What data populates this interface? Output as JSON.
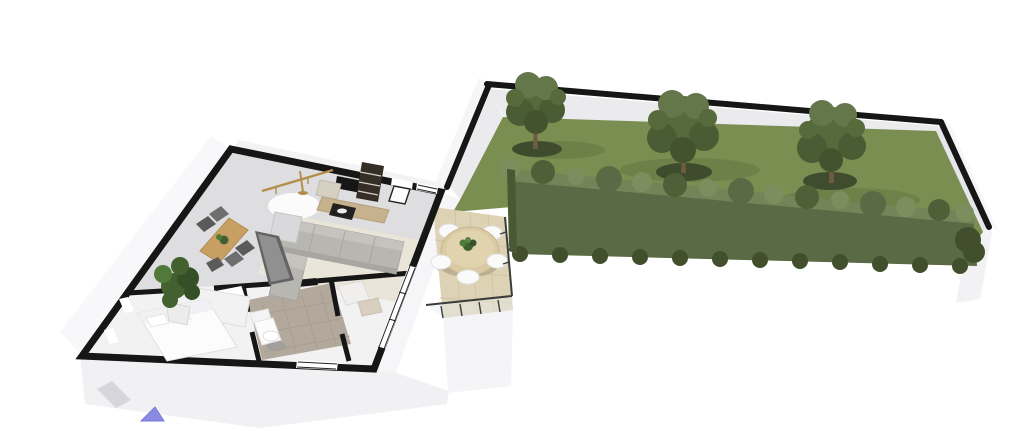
{
  "scene": {
    "type": "floorplanner-3d-view",
    "background": "#ffffff",
    "colors": {
      "wall": "#161616",
      "wall_face": "#ebebee",
      "exterior_face": "#f4f4f6",
      "floor_living": "#dedee0",
      "floor_white": "#f2f2f3",
      "rug": "#e9e5d9",
      "round_rug": "#fcfcfc",
      "sofa": "#b8b6b1",
      "sofa_light": "#c5c3be",
      "coffee_table": "#23211f",
      "tv": "#161616",
      "sideboard": "#c6b28d",
      "shelf": "#352e26",
      "brass": "#b28f49",
      "armchair": "#d6d0c2",
      "wood": "#c79f62",
      "chair_dark": "#5a5a5a",
      "kitchen_dark": "#646464",
      "kitchen_top": "#909090",
      "cabinet": "#d9d9db",
      "bathroom_tile": "#b2a89b",
      "fixture": "#fcfcfd",
      "plant": "#42612f",
      "pot": "#ececea",
      "terrace_floor": "#ddd2b4",
      "terrace_table": "#d9caa3",
      "railing": "#3c3c3c",
      "glass": "#e9eef1",
      "grass": "#7a8e52",
      "grass_dark": "#55682f",
      "hedge": "#5a6a44",
      "hedge_light": "#7c8e5e",
      "hedge_dark": "#414f2c",
      "tree": "#566a3c",
      "tree_light": "#63774a",
      "tree_dark": "#42532e",
      "tree_shadow": "#39462a",
      "trunk": "#6f5b40",
      "camera_marker": "#8a8ae4"
    },
    "garden": {
      "tree_count": 3,
      "has_hedge": true,
      "has_lawn": true,
      "enclosed_by_walls": true
    },
    "terrace": {
      "chair_count": 5,
      "has_round_table": true,
      "has_railing": true,
      "has_centerpiece_plant": true
    },
    "apartment": {
      "rooms": [
        "living-room",
        "kitchen-dining",
        "bedroom",
        "bathroom",
        "hallway"
      ],
      "furniture": [
        "sofa",
        "coffee-table",
        "tv-sideboard",
        "tv",
        "bookshelf",
        "floor-lamp",
        "armchair",
        "round-rug",
        "area-rug",
        "dining-table",
        "dining-chairs",
        "kitchen-counter",
        "kitchen-cabinet",
        "bed",
        "wardrobe",
        "potted-plant",
        "toilet",
        "shower-tray",
        "bath-mat"
      ],
      "dining_chair_count": 5
    }
  }
}
